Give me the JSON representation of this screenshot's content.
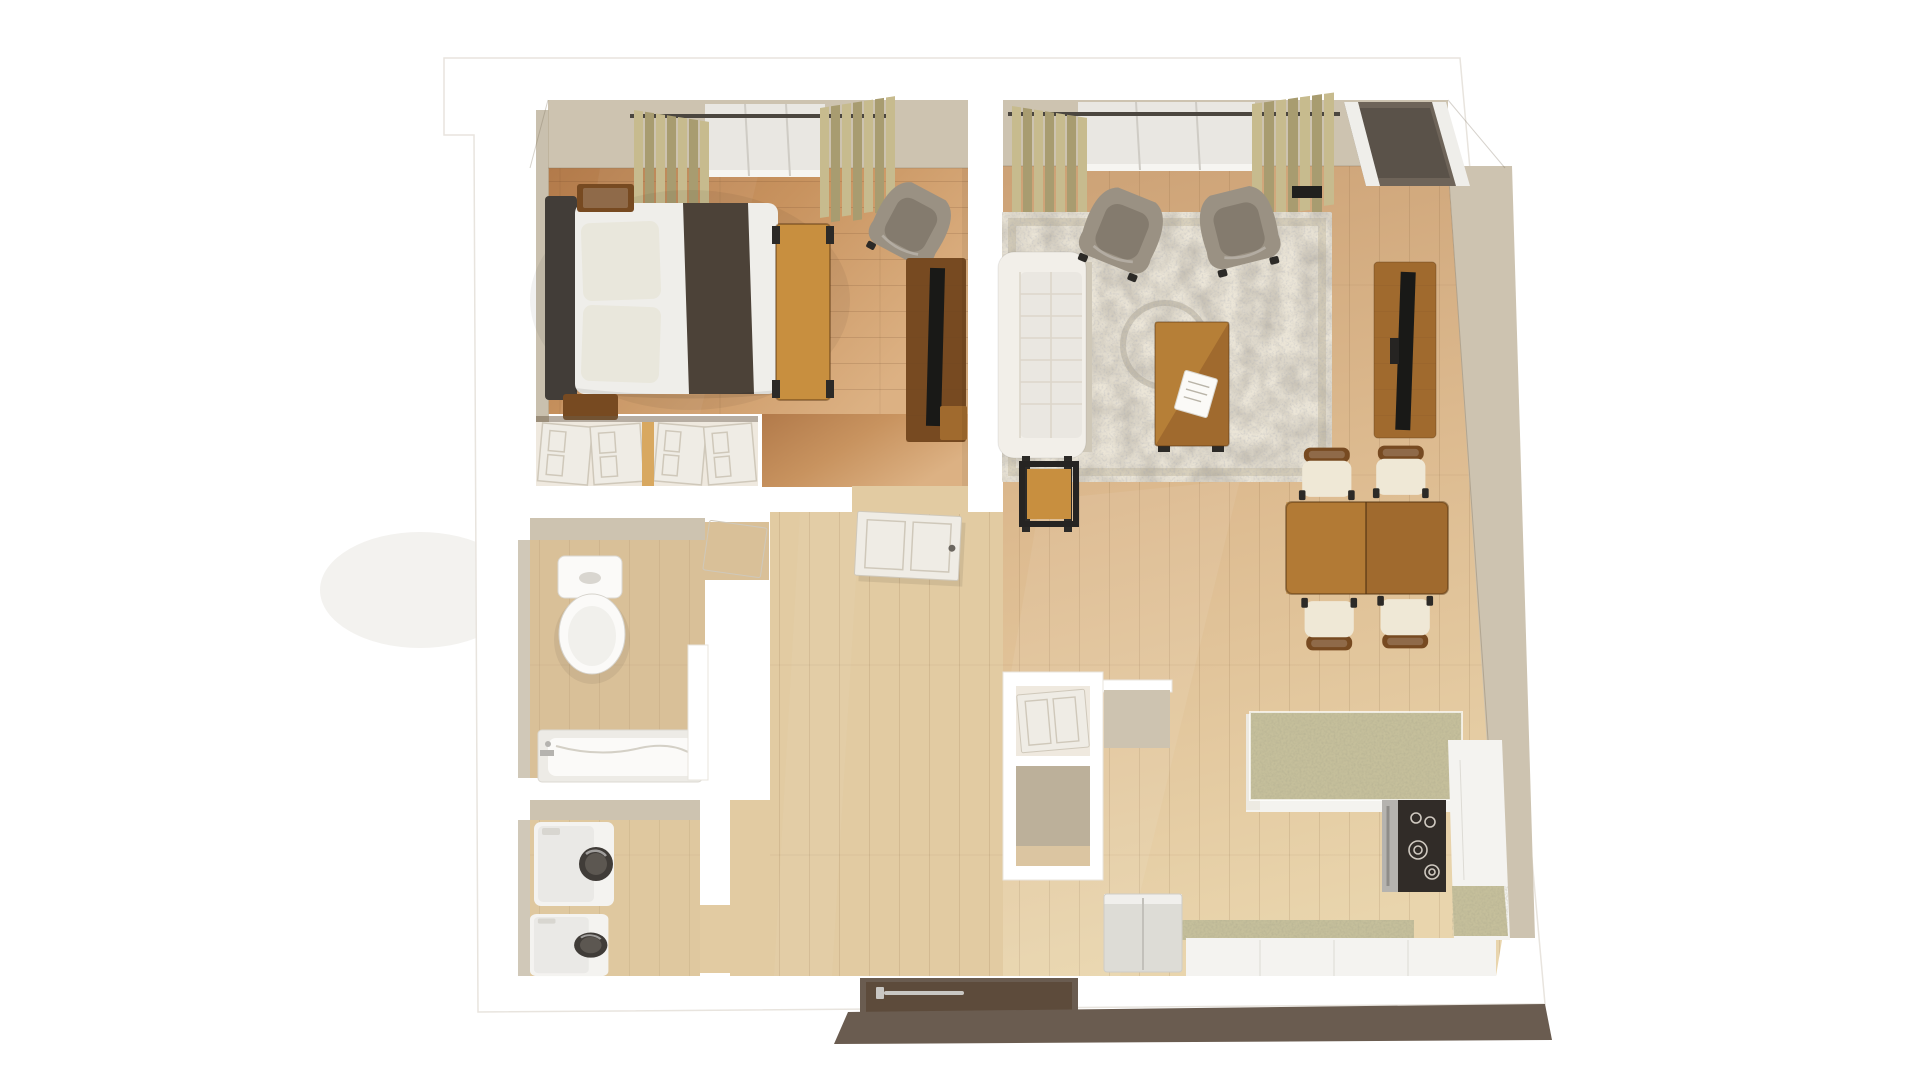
{
  "scene": {
    "title": "3D top-down floor plan render — one-bedroom apartment",
    "view": "bird's-eye dollhouse render, white cut walls, wood floors",
    "background": "#ffffff"
  },
  "palette": {
    "wall": "#ffffff",
    "wall_line": "#e8e4de",
    "wall_face": "#cdc3b0",
    "wall_face_dark": "#bcb09a",
    "wall_outer_dark": "#6a5c50",
    "floor_bed_a": "#b27a4a",
    "floor_bed_b": "#c8935f",
    "floor_bed_c": "#dcb183",
    "floor_main_a": "#cda276",
    "floor_main_b": "#ddbb90",
    "floor_main_c": "#e9d5ad",
    "floor_bath": "#d9c098",
    "floor_laundry": "#dfc89f",
    "floor_hall": "#e2cba2",
    "rug_base": "#ebe5d7",
    "rug_border": "#d8d0bc",
    "sofa": "#f2efe9",
    "sofa_line": "#dcd6ca",
    "sofa_base": "#cfc8b8",
    "armchair": "#9a9183",
    "armchair_dark": "#847b6e",
    "chair_leg": "#2c2a27",
    "wood_dark": "#774a21",
    "wood_mid": "#a06a2e",
    "wood_light": "#c88f3f",
    "wood_pale": "#d8a860",
    "headboard": "#423d38",
    "bed_white": "#efeeea",
    "bed_pillow": "#e9e7dc",
    "bed_throw": "#4c4238",
    "tv_black": "#191917",
    "curtain": "#c7bb8e",
    "curtain_dark": "#a89c70",
    "curtain_rod": "#4b463f",
    "glass": "#e9e7e2",
    "granite": "#c5bf9b",
    "cooktop": "#312c28",
    "steel": "#b5b3af",
    "appliance": "#f4f3f0",
    "fridge": "#dddcd6",
    "door_white": "#efece5",
    "door_line": "#cfc8ba",
    "door_brown": "#5d4b3b",
    "handle_silver": "#c9c7c3",
    "slider_mat": "#6e6459",
    "mat_black": "#20201e"
  },
  "rooms": {
    "bedroom": {
      "label": "Bedroom",
      "furniture": [
        "double bed with dark headboard and brown throw",
        "two wood nightstands",
        "wood bench at foot of bed",
        "gray armchair",
        "dresser with TV",
        "window with khaki curtains",
        "double-door closet"
      ]
    },
    "living_room": {
      "label": "Living room",
      "furniture": [
        "white tufted sofa",
        "two gray armchairs",
        "wood coffee table with papers",
        "ornate ivory area rug",
        "wood side table",
        "media console with TV",
        "window with khaki curtains",
        "patio sliding door"
      ]
    },
    "dining_area": {
      "label": "Dining area",
      "furniture": [
        "rectangular wood dining table",
        "four chairs with cream cushions"
      ]
    },
    "kitchen": {
      "label": "Kitchen",
      "furniture": [
        "granite-top island",
        "range with black cooktop",
        "white cabinets and counters",
        "refrigerator",
        "partition wing wall"
      ]
    },
    "bathroom": {
      "label": "Bathroom",
      "furniture": [
        "toilet",
        "bathtub with marble surround",
        "privacy partition"
      ]
    },
    "laundry_closet": {
      "label": "Laundry closet",
      "furniture": [
        "washer",
        "dryer"
      ]
    },
    "hallway": {
      "label": "Hallway",
      "furniture": [
        "open bedroom door",
        "double storage closet"
      ]
    },
    "entry": {
      "label": "Entry",
      "furniture": [
        "dark brown front door with silver handle"
      ]
    }
  },
  "openings": {
    "windows": 2,
    "sliding_doors": 1,
    "entry_doors": 1,
    "interior_doors": 3
  }
}
